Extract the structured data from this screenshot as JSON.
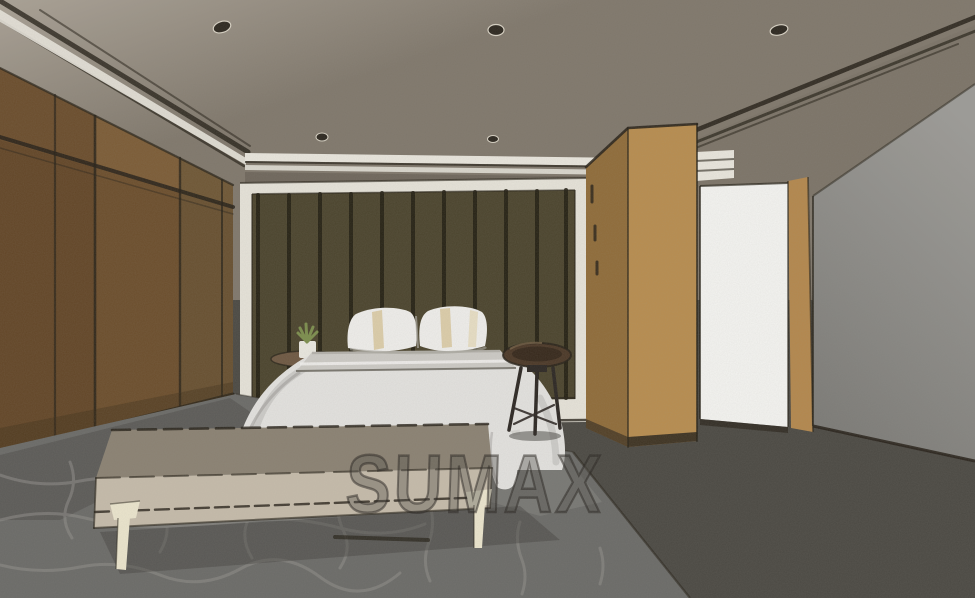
{
  "watermark": {
    "text": "SUMAX"
  },
  "scene": {
    "type": "interior-design-3d-rendering",
    "room": "bedroom",
    "style": "sketch-watercolor render",
    "objects": [
      "ceiling-recessed-lights",
      "cove-molding",
      "wood-panel-wardrobe-wall",
      "slatted-headboard-feature-wall",
      "bed-with-white-duvet",
      "striped-pillows",
      "floating-bedside-shelf-with-plant",
      "round-dark-wood-stool",
      "upholstered-bench-with-cream-legs",
      "tall-wood-cabinet",
      "bright-open-doorway",
      "patterned-gray-rug",
      "dark-carpet-floor",
      "gray-side-wall"
    ]
  },
  "colors": {
    "ceiling_top": "#a9a195",
    "ceiling_main": "#7f776b",
    "cove_shade": "#776f63",
    "molding_white": "#e9e6dd",
    "ink": "#241f16",
    "soffit": "#6e665b",
    "light_fixture": "#2b261e",
    "light_rim": "#d8d2c4",
    "wardrobe_base": "#6b4d2b",
    "wardrobe_light": "#7d5d36",
    "wardrobe_dark": "#5a3d21",
    "wardrobe_olive": "#645233",
    "wardrobe_shadow": "#3a2c18",
    "headboard_frame": "#e6e3d9",
    "headboard_wall": "#4a432c",
    "batten": "#1f1b0f",
    "cabinet_front": "#b78c4e",
    "cabinet_side": "#8f6b38",
    "cabinet_base": "#28221a",
    "door_white": "#f4f4f1",
    "door_wood": "#b3874c",
    "wall_top": "#9c9b97",
    "wall_bottom": "#7b7a76",
    "floor": "#4a4842",
    "rug": "#6a6a67",
    "rug_crack": "#8e8d88",
    "rug_light": "#7e7d79",
    "rug_shadow": "#3f3d39",
    "duvet": "#e3e2df",
    "duvet_shade": "#b5b4b1",
    "duvet_crease": "#9c9b98",
    "sheet_band": "#cac8c3",
    "sheet_highlight": "#f2f1ee",
    "pillow": "#efeeeb",
    "pillow_stripe": "#d9c9a2",
    "pillow_stripe_light": "#e4d7b4",
    "pillow_shadow": "#a9a79f",
    "bench_top": "#8a8172",
    "bench_front": "#c5bbaa",
    "bench_leg": "#ebe5cd",
    "stool_seat": "#4a3726",
    "stool_seat_dark": "#2f2318",
    "stool_rim": "#8a7152",
    "stool_leg": "#2b2622",
    "nightstand_top": "#6d5741",
    "pot": "#e9e7df",
    "plant": "#7b8d4c",
    "watermark_fill": "rgba(80,76,70,0.38)",
    "watermark_stroke": "rgba(35,32,28,0.5)"
  }
}
